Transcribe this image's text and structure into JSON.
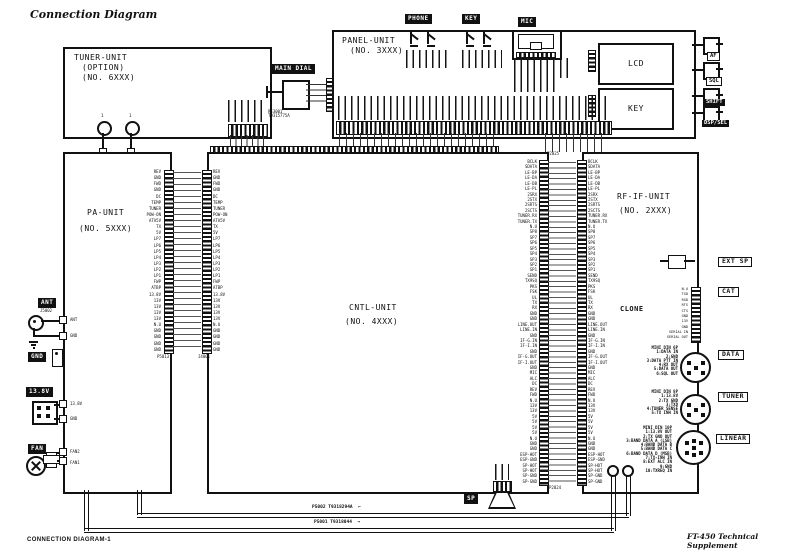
{
  "page": {
    "title": "Connection Diagram",
    "footer_left": "CONNECTION DIAGRAM-1",
    "footer_right": "FT-450 Technical Supplement"
  },
  "colors": {
    "ink": "#111111",
    "paper": "#ffffff"
  },
  "units": {
    "tuner": {
      "l1": "TUNER-UNIT",
      "l2": "(OPTION)",
      "l3": "(NO. 6XXX)"
    },
    "panel": {
      "l1": "PANEL-UNIT",
      "l2": "(NO. 3XXX)"
    },
    "pa": {
      "l1": "PA-UNIT",
      "l2": "(NO. 5XXX)"
    },
    "cntl": {
      "l1": "CNTL-UNIT",
      "l2": "(NO. 4XXX)"
    },
    "rfif": {
      "l1": "RF-IF-UNIT",
      "l2": "(NO. 2XXX)"
    }
  },
  "front": {
    "phone": "PHONE",
    "key": "KEY",
    "mic": "MIC",
    "main_dial": "MAIN DIAL",
    "lcd": "LCD",
    "key_block": "KEY",
    "coax_pin": "1",
    "encoder_ref1": "RE3001",
    "encoder_ref2": "T9315775A",
    "controls": [
      {
        "label": "AF",
        "style": "outline"
      },
      {
        "label": "SQL",
        "style": "outline"
      },
      {
        "label": "SHIFT",
        "style": "inverse"
      },
      {
        "label": "DSP/SEL",
        "style": "inverse"
      }
    ]
  },
  "rear_left": {
    "ant": "ANT",
    "ant_ref": "J5002",
    "gnd": "GND",
    "dc": "13.8V",
    "fan": "FAN"
  },
  "pa_edge": [
    "ANT",
    "GND",
    "13.8V",
    "GND",
    "FAN2",
    "FAN1"
  ],
  "pa_cntl": {
    "ref_left": "P5013",
    "ref_right": "J4001",
    "pins": [
      "REV",
      "GND",
      "FWD",
      "GND",
      "DC",
      "TEMP",
      "TUNER",
      "POW-ON",
      "ATA5V",
      "TX",
      "5V",
      "LP7",
      "LP6",
      "LP5",
      "LP4",
      "LP3",
      "LP2",
      "LP1",
      "FWP",
      "ATBP",
      "13.8V",
      "13V",
      "13V",
      "13V",
      "13V",
      "N.U",
      "GND",
      "GND",
      "GND",
      "GND"
    ]
  },
  "cntl_rfif": {
    "ref_top": "P2025",
    "ref_bottom": "P2024",
    "pins": [
      "BCLK",
      "SDATA",
      "LE-BP",
      "LE-DA",
      "LE-DB",
      "LE-PL",
      "2SRX",
      "2STX",
      "2SRTS",
      "2SCTS",
      "TUNER.RX",
      "TUNER.TX",
      "N.U",
      "SP8",
      "SP7",
      "SP6",
      "SP5",
      "SP4",
      "SP3",
      "SP2",
      "SP1",
      "SEND",
      "TX9SQ",
      "PKS",
      "FSK",
      "UL",
      "TX",
      "RX",
      "GND",
      "GND",
      "LINE.OUT",
      "LINE.IN",
      "GND",
      "IF-G.IN",
      "IF-I.IN",
      "GND",
      "IF-G.OUT",
      "IF-I.OUT",
      "GND",
      "MIC",
      "ALC",
      "DC",
      "REV",
      "FWD",
      "N.U",
      "13V",
      "13V",
      "5V",
      "5V",
      "5V",
      "5V",
      "N.U",
      "GND",
      "GND",
      "ESP-HOT",
      "ESP-GND",
      "SP-HOT",
      "SP-HOT",
      "SP-GND",
      "SP-GND"
    ]
  },
  "rear_right": {
    "ext_sp": "EXT SP",
    "cat": "CAT",
    "clone": "CLONE",
    "data": "DATA",
    "tuner": "TUNER",
    "linear": "LINEAR",
    "cat_pins": [
      "N.U",
      "TXD",
      "RXD",
      "RTS",
      "CTS",
      "GND",
      "13V",
      "GND",
      "SERIAL IN",
      "SERIAL OUT"
    ],
    "data_pinout": [
      "MINI DIN 6P",
      "1:DATA IN",
      "2:GND",
      "3:DATA PTT IN",
      "4:RX OUT",
      "5:DATA OUT",
      "6:SQL OUT"
    ],
    "tuner_pinout": [
      "MINI DIN 8P",
      "1:13.8V",
      "2:TX GND",
      "3:TXD",
      "4:TUNER SENSE",
      "5:TX INH IN"
    ],
    "linear_pinout": [
      "MINI DIN 10P",
      "1:13.8V OUT",
      "2:TX GND OUT",
      "3:BAND DATA A (LSB)",
      "4:BAND DATA B",
      "5:BAND DATA C",
      "6:BAND DATA D (MSB)",
      "7:TX-INH IN",
      "8:EXT ALC IN",
      "9:GND",
      "10:TXREQ IN"
    ]
  },
  "speaker": {
    "label": "SP"
  },
  "bottom_wires": {
    "w1_ref": "P5002 T9318294A",
    "w1_arrow": "←",
    "w2_ref": "P5001 T9318044",
    "w2_arrow": "→"
  }
}
